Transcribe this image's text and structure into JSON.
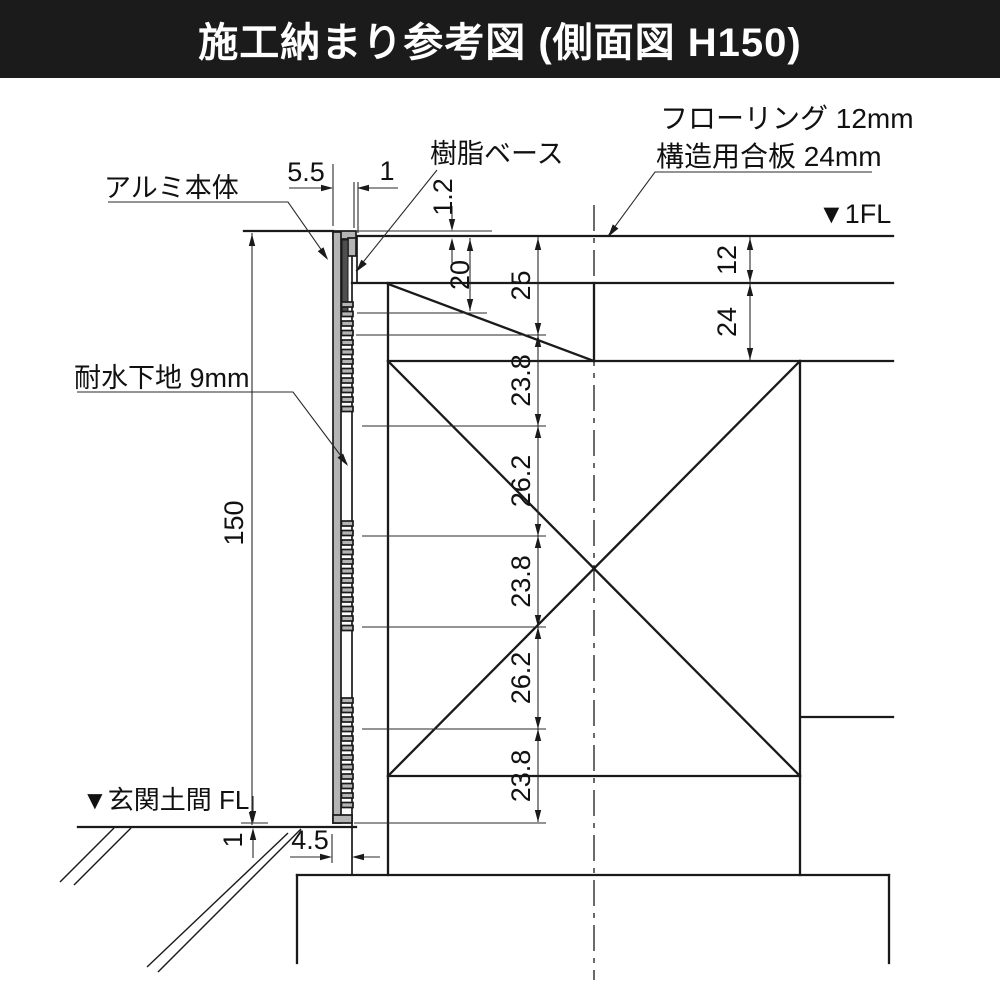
{
  "title": "施工納まり参考図 (側面図 H150)",
  "labels": {
    "flooring": "フローリング 12mm",
    "plywood": "構造用合板 24mm",
    "aluminum_body": "アルミ本体",
    "resin_base": "樹脂ベース",
    "substrate": "耐水下地 9mm",
    "fl_1": "▼1FL",
    "fl_entrance": "▼玄関土間 FL"
  },
  "dimensions": {
    "top_body_width": "5.5",
    "top_clearance": "1",
    "top_protrusion": "1.2",
    "notch_height": "20",
    "flooring_thickness": "12",
    "plywood_thickness": "24",
    "body_height": "150",
    "bottom_width": "4.5",
    "bottom_clearance": "1",
    "chain": [
      "25",
      "23.8",
      "26.2",
      "23.8",
      "26.2",
      "23.8"
    ]
  },
  "colors": {
    "line": "#1a1a1a",
    "profile_fill": "#b5b5b5",
    "resin_fill": "#4f4f4f",
    "title_bg": "#1b1b1b",
    "title_fg": "#ffffff",
    "background": "#ffffff"
  }
}
